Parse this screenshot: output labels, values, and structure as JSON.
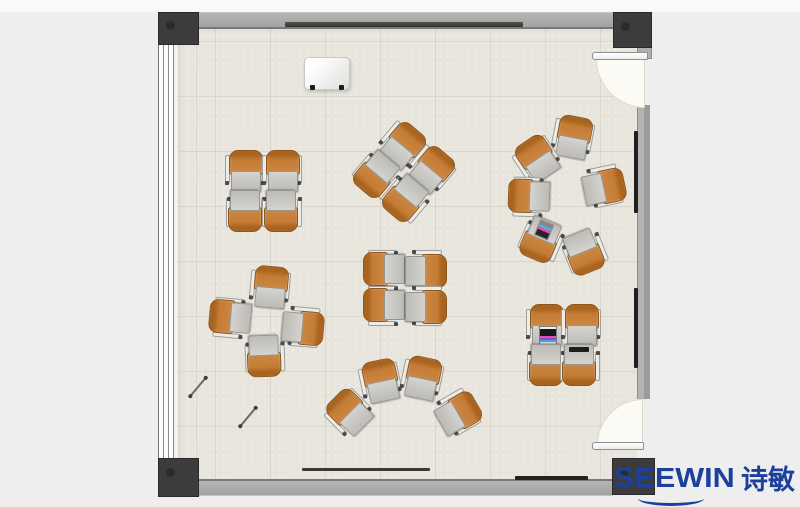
{
  "logo": {
    "text": "SEEWIN",
    "cn": "诗敏",
    "color": "#1c409b"
  },
  "palette": {
    "floor": "#e8e5dd",
    "wall": "#a9a9a9",
    "column": "#3c3c3c",
    "chair_orange": "#c47c35",
    "desk_gray": "#c6c5c1",
    "outside": "#eeeeee",
    "logo_blue": "#1c409b"
  },
  "floorplan": {
    "clusters": [
      {
        "name": "pod-top-left",
        "units": [
          {
            "x": 245,
            "y": 170,
            "r": 0
          },
          {
            "x": 282,
            "y": 170,
            "r": 0
          },
          {
            "x": 246,
            "y": 212,
            "r": 180
          },
          {
            "x": 282,
            "y": 212,
            "r": 180
          }
        ]
      },
      {
        "name": "pod-diagonal",
        "units": [
          {
            "x": 403,
            "y": 144,
            "r": 40
          },
          {
            "x": 432,
            "y": 168,
            "r": 40
          },
          {
            "x": 376,
            "y": 176,
            "r": 220
          },
          {
            "x": 405,
            "y": 200,
            "r": 220
          }
        ]
      },
      {
        "name": "discussion-circle",
        "units": [
          {
            "x": 573,
            "y": 136,
            "r": 11
          },
          {
            "x": 536,
            "y": 158,
            "r": -34
          },
          {
            "x": 528,
            "y": 197,
            "r": -88
          },
          {
            "x": 541,
            "y": 241,
            "r": -157,
            "acc": "laptop2"
          },
          {
            "x": 605,
            "y": 186,
            "r": 78
          },
          {
            "x": 585,
            "y": 253,
            "r": 158
          }
        ]
      },
      {
        "name": "pinwheel",
        "units": [
          {
            "x": 270,
            "y": 286,
            "r": 5
          },
          {
            "x": 229,
            "y": 318,
            "r": -85
          },
          {
            "x": 304,
            "y": 327,
            "r": 95
          },
          {
            "x": 265,
            "y": 357,
            "r": 178
          }
        ]
      },
      {
        "name": "pod-center-facing",
        "units": [
          {
            "x": 383,
            "y": 270,
            "r": -90
          },
          {
            "x": 383,
            "y": 306,
            "r": -90
          },
          {
            "x": 427,
            "y": 270,
            "r": 90
          },
          {
            "x": 427,
            "y": 306,
            "r": 90
          }
        ]
      },
      {
        "name": "arc-row",
        "units": [
          {
            "x": 348,
            "y": 412,
            "r": -45
          },
          {
            "x": 380,
            "y": 380,
            "r": -12
          },
          {
            "x": 422,
            "y": 377,
            "r": 12
          },
          {
            "x": 459,
            "y": 412,
            "r": 60
          }
        ]
      },
      {
        "name": "pod-bottom-right",
        "units": [
          {
            "x": 546,
            "y": 324,
            "r": 0,
            "acc": "laptop"
          },
          {
            "x": 581,
            "y": 324,
            "r": 0
          },
          {
            "x": 547,
            "y": 366,
            "r": 180
          },
          {
            "x": 580,
            "y": 366,
            "r": 180,
            "acc": "tablet"
          }
        ]
      }
    ],
    "loose_items": [
      {
        "name": "pen",
        "x": 198,
        "y": 387,
        "r": -50
      },
      {
        "name": "pen",
        "x": 248,
        "y": 417,
        "r": -50
      }
    ]
  }
}
